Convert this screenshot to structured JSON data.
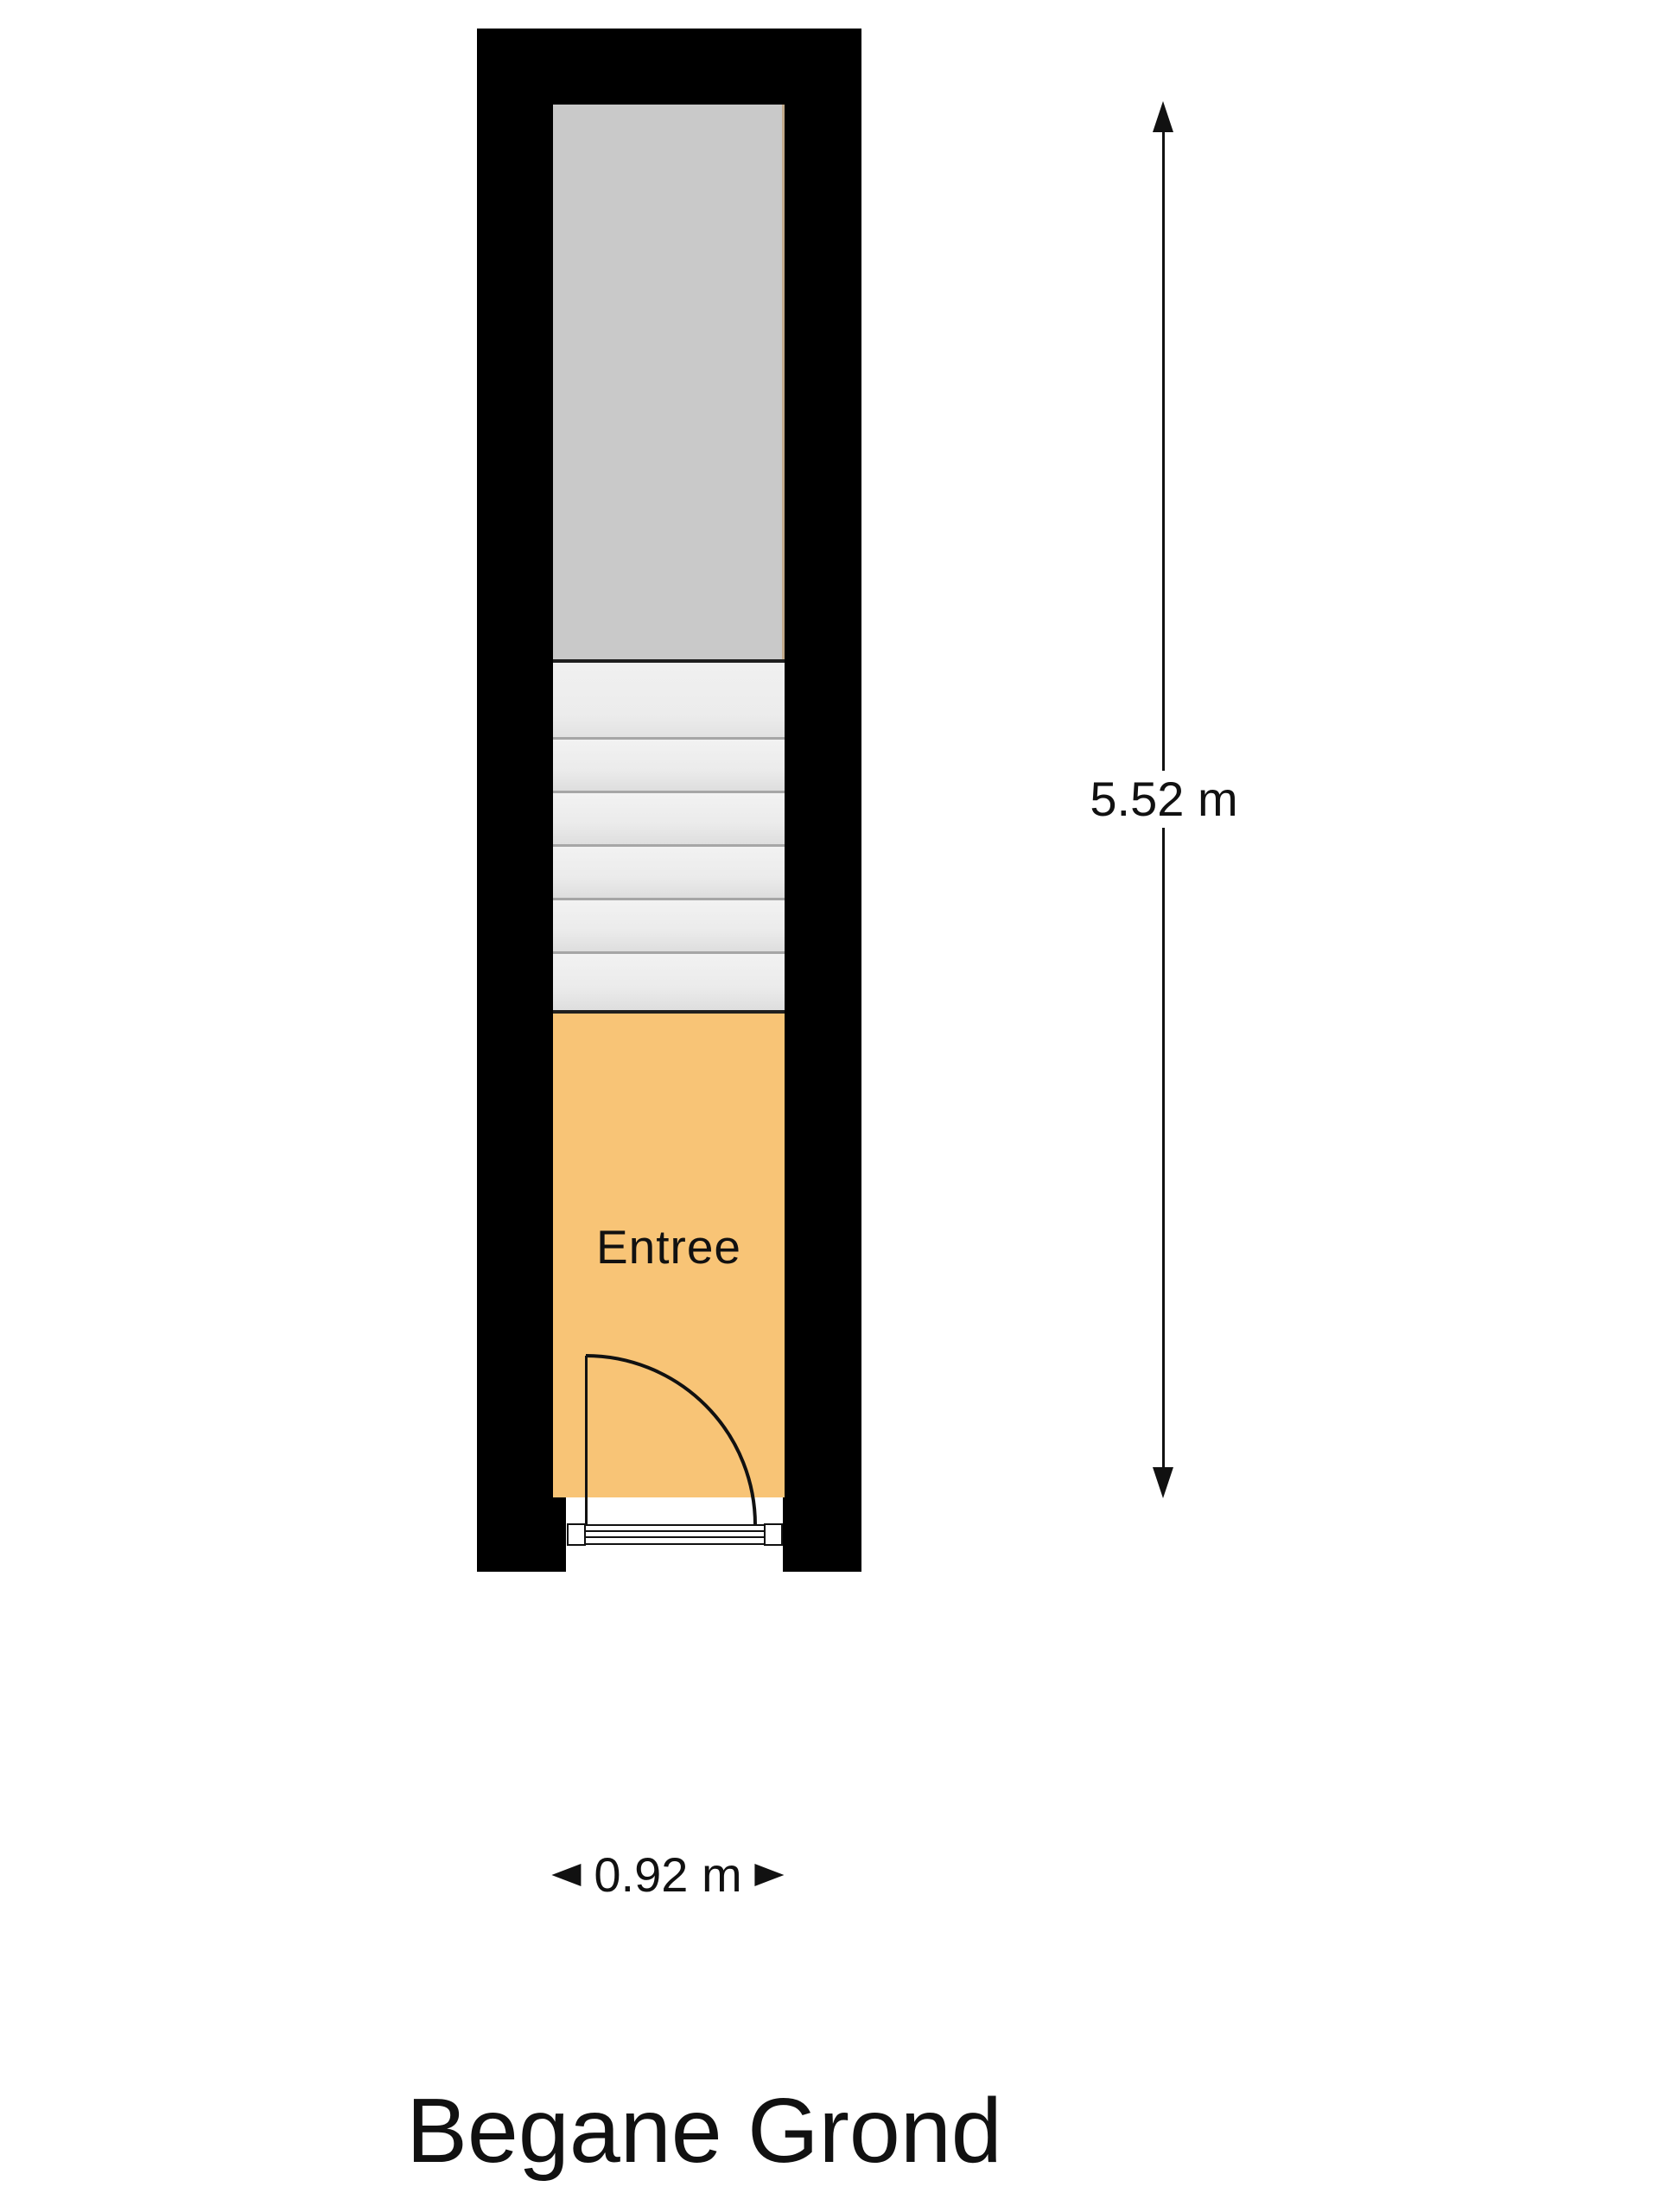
{
  "plan": {
    "title": "Begane Grond",
    "rooms": {
      "entree": {
        "label": "Entree"
      }
    },
    "stairs": {
      "tread_count": 5,
      "has_landing": true
    },
    "dimensions": {
      "vertical_label": "5.52 m",
      "horizontal_label": "0.92 m"
    },
    "icons": {
      "vertical_top": "arrow-up-icon",
      "vertical_bottom": "arrow-down-icon",
      "horizontal_left": "arrow-left-icon",
      "horizontal_right": "arrow-right-icon"
    },
    "colors": {
      "wall": "#000000",
      "upper_room_fill": "#c9c9c9",
      "stairs_fill": "#efefef",
      "stair_line": "#a6a6a6",
      "separator": "#1f1f1f",
      "entree_fill": "#f8c476",
      "line": "#111111",
      "background": "#ffffff"
    }
  }
}
